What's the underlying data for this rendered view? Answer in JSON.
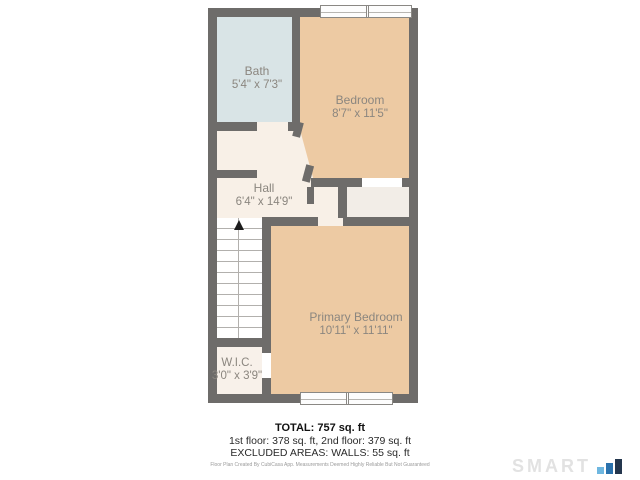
{
  "plan": {
    "rooms": [
      {
        "name": "Bath",
        "dimensions": "5'4\" x 7'3\""
      },
      {
        "name": "Bedroom",
        "dimensions": "8'7\" x 11'5\""
      },
      {
        "name": "Hall",
        "dimensions": "6'4\" x 14'9\""
      },
      {
        "name": "Primary Bedroom",
        "dimensions": "10'11\" x 11'11\""
      },
      {
        "name": "W.I.C.",
        "dimensions": "3'0\" x 3'9\""
      }
    ],
    "features": {
      "stairs_direction": "up",
      "windows": [
        "top double window",
        "bottom double window"
      ]
    },
    "colors": {
      "wall": "#6e6c6a",
      "bath": "#d9e4e6",
      "bedroom": "#edcaa3",
      "hall": "#f8f0e7",
      "closet": "#f2ede7",
      "wic": "#f8f1ea",
      "label_text": "#8b867f"
    }
  },
  "summary": {
    "total": "TOTAL: 757 sq. ft",
    "floors": "1st floor: 378 sq. ft, 2nd floor: 379 sq. ft",
    "excluded": "EXCLUDED AREAS: WALLS: 55 sq. ft",
    "disclaimer": "Floor Plan Created By CubiCasa App. Measurements Deemed Highly Reliable But Not Guaranteed"
  },
  "branding": {
    "logo_text": "SMART",
    "bar_colors": [
      "#6fb7e0",
      "#2b72ad",
      "#24364d"
    ]
  }
}
